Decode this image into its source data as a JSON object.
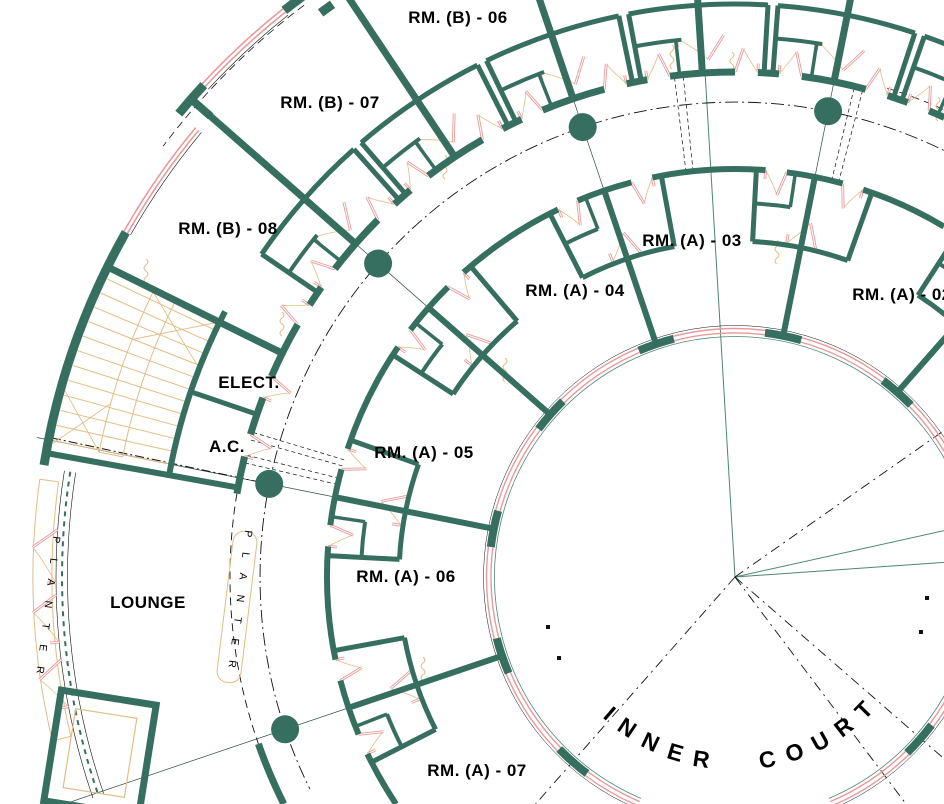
{
  "drawing": {
    "type": "architectural-floor-plan",
    "description": "Partial plan of a circular building wing with two concentric rings of guest rooms around an inner court",
    "rooms": {
      "b06": {
        "label": "RM. (B) - 06"
      },
      "b07": {
        "label": "RM. (B) - 07"
      },
      "b08": {
        "label": "RM. (B) - 08"
      },
      "a02": {
        "label": "RM. (A) - 02"
      },
      "a03": {
        "label": "RM. (A) - 03"
      },
      "a04": {
        "label": "RM. (A) - 04"
      },
      "a05": {
        "label": "RM. (A) - 05"
      },
      "a06": {
        "label": "RM. (A) - 06"
      },
      "a07": {
        "label": "RM. (A) - 07"
      },
      "elect": {
        "label": "ELECT."
      },
      "ac": {
        "label": "A.C."
      },
      "lounge": {
        "label": "LOUNGE"
      }
    },
    "court": {
      "label": "INNER COURT"
    },
    "planter_left": {
      "label": "PLANTER"
    },
    "planter_mid": {
      "label": "PLANTER"
    },
    "colors": {
      "wall_teal": "#366f60",
      "thin_teal": "#4d8676",
      "glazing_pink": "#e89a9a",
      "accent_tan": "#e2bd85",
      "line_black": "#111111",
      "background": "#ffffff"
    }
  }
}
